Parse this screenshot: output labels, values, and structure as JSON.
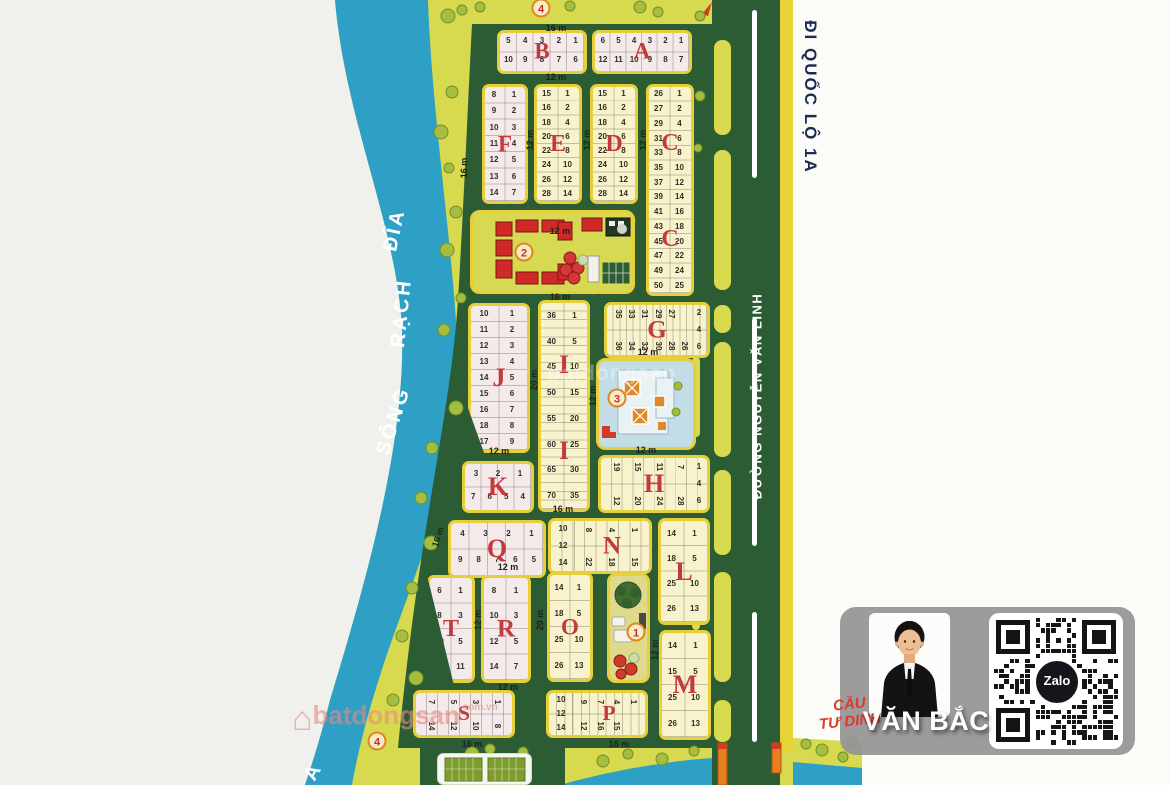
{
  "colors": {
    "paper": "#f0f1ec",
    "paperR": "#fbfbf8",
    "land": "#d7d94f",
    "river": "#2e9fc5",
    "green": "#2b5c33",
    "stripe": "#e8d337",
    "blockBorder": "#e6cf3a",
    "pink": "#f4eaea",
    "lightYellow": "#f8f3cd",
    "letterRed": "#c23a3c",
    "badgeRing": "#e0861f",
    "badgeText": "#cf2b20",
    "navy": "#1c2b52",
    "bridgeRed": "#df392c"
  },
  "map": {
    "river_words": [
      {
        "t": "ĐĨA",
        "x": 395,
        "y": 230,
        "r": -78
      },
      {
        "t": "RẠCH",
        "x": 402,
        "y": 313,
        "r": -84
      },
      {
        "t": "SÔNG",
        "x": 394,
        "y": 421,
        "r": -72
      }
    ],
    "corner_letter": {
      "t": "A"
    },
    "road_main_label": "ĐƯỜNG NGUYỄN VĂN LINH",
    "exit_label": "ĐI QUỐC LỘ 1A",
    "bridge_label_line1": "CẦU",
    "bridge_label_line2": "TƯ DINH",
    "watermark": {
      "text": "batdongsan",
      "suffix": ".com.vn"
    },
    "street_labels": [
      {
        "t": "16 m",
        "x": 556,
        "y": 28,
        "r": 0
      },
      {
        "t": "12 m",
        "x": 556,
        "y": 77,
        "r": 0
      },
      {
        "t": "16 m",
        "x": 464,
        "y": 168,
        "r": -90
      },
      {
        "t": "12 m",
        "x": 530,
        "y": 140,
        "r": -90
      },
      {
        "t": "12 m",
        "x": 587,
        "y": 140,
        "r": -90
      },
      {
        "t": "12 m",
        "x": 643,
        "y": 140,
        "r": -90
      },
      {
        "t": "12 m",
        "x": 560,
        "y": 231,
        "r": 0
      },
      {
        "t": "16 m",
        "x": 560,
        "y": 297,
        "r": 0
      },
      {
        "t": "20 m",
        "x": 534,
        "y": 380,
        "r": -90
      },
      {
        "t": "12 m",
        "x": 593,
        "y": 396,
        "r": -90
      },
      {
        "t": "12 m",
        "x": 648,
        "y": 352,
        "r": 0
      },
      {
        "t": "12 m",
        "x": 499,
        "y": 451,
        "r": 0
      },
      {
        "t": "12 m",
        "x": 646,
        "y": 450,
        "r": 0
      },
      {
        "t": "16 m",
        "x": 563,
        "y": 509,
        "r": 0
      },
      {
        "t": "16 m",
        "x": 438,
        "y": 537,
        "r": -72
      },
      {
        "t": "12 m",
        "x": 508,
        "y": 567,
        "r": 0
      },
      {
        "t": "12 m",
        "x": 478,
        "y": 620,
        "r": -90
      },
      {
        "t": "20 m",
        "x": 540,
        "y": 620,
        "r": -90
      },
      {
        "t": "12 m",
        "x": 655,
        "y": 650,
        "r": -90
      },
      {
        "t": "12 m",
        "x": 508,
        "y": 687,
        "r": 0
      },
      {
        "t": "16 m",
        "x": 472,
        "y": 744,
        "r": 0
      },
      {
        "t": "16 m",
        "x": 619,
        "y": 744,
        "r": 0
      }
    ],
    "badges": [
      {
        "n": "4",
        "x": 541,
        "y": 8
      },
      {
        "n": "2",
        "x": 524,
        "y": 252
      },
      {
        "n": "3",
        "x": 617,
        "y": 398
      },
      {
        "n": "1",
        "x": 636,
        "y": 632
      },
      {
        "n": "4",
        "x": 377,
        "y": 741
      }
    ],
    "blocks": [
      {
        "id": "B",
        "letter": "B",
        "x": 497,
        "y": 30,
        "w": 90,
        "h": 44,
        "fill": "pink",
        "type": "h2",
        "top": [
          "5",
          "4",
          "3",
          "2",
          "1"
        ],
        "bottom": [
          "10",
          "9",
          "8",
          "7",
          "6"
        ]
      },
      {
        "id": "A",
        "letter": "A",
        "x": 592,
        "y": 30,
        "w": 100,
        "h": 44,
        "fill": "pink",
        "type": "h2",
        "top": [
          "6",
          "5",
          "4",
          "3",
          "2",
          "1"
        ],
        "bottom": [
          "12",
          "11",
          "10",
          "9",
          "8",
          "7"
        ]
      },
      {
        "id": "F",
        "letter": "F",
        "x": 482,
        "y": 84,
        "w": 46,
        "h": 120,
        "fill": "pink",
        "type": "v2",
        "left": [
          "8",
          "9",
          "10",
          "11",
          "12",
          "13",
          "14"
        ],
        "right": [
          "1",
          "2",
          "3",
          "4",
          "5",
          "6",
          "7"
        ]
      },
      {
        "id": "E",
        "letter": "E",
        "x": 534,
        "y": 84,
        "w": 48,
        "h": 120,
        "fill": "yellow",
        "type": "v2",
        "left": [
          "15",
          "16",
          "18",
          "20",
          "22",
          "24",
          "26",
          "28"
        ],
        "right": [
          "1",
          "2",
          "4",
          "6",
          "8",
          "10",
          "12",
          "14"
        ]
      },
      {
        "id": "D",
        "letter": "D",
        "x": 590,
        "y": 84,
        "w": 48,
        "h": 120,
        "fill": "yellow",
        "type": "v2",
        "left": [
          "15",
          "16",
          "18",
          "20",
          "22",
          "24",
          "26",
          "28"
        ],
        "right": [
          "1",
          "2",
          "4",
          "6",
          "8",
          "10",
          "12",
          "14"
        ]
      },
      {
        "id": "C",
        "letter": "C",
        "letterPos": [
          0.27,
          0.74
        ],
        "x": 646,
        "y": 84,
        "w": 48,
        "h": 212,
        "fill": "yellow",
        "type": "v2",
        "left": [
          "26",
          "27",
          "29",
          "31",
          "33",
          "35",
          "37",
          "39",
          "41",
          "43",
          "45",
          "47",
          "49",
          "50"
        ],
        "right": [
          "1",
          "2",
          "4",
          "6",
          "8",
          "10",
          "12",
          "14",
          "16",
          "18",
          "20",
          "22",
          "24",
          "25"
        ]
      },
      {
        "id": "J",
        "letter": "J",
        "x": 468,
        "y": 303,
        "w": 62,
        "h": 150,
        "fill": "pink",
        "type": "v2",
        "left": [
          "10",
          "11",
          "12",
          "13",
          "14",
          "15",
          "16",
          "18",
          "17"
        ],
        "right": [
          "1",
          "2",
          "3",
          "4",
          "5",
          "6",
          "7",
          "8",
          "9"
        ],
        "clip": "polygon(0 0, 100% 0, 100% 100%, 26% 100%, 0 70%)"
      },
      {
        "id": "I",
        "letter": "I",
        "letterPos": [
          0.3,
          0.72
        ],
        "x": 538,
        "y": 300,
        "w": 52,
        "h": 212,
        "fill": "yellow",
        "type": "v2",
        "sub": 3,
        "left": [
          "36",
          "40",
          "45",
          "50",
          "55",
          "60",
          "65",
          "70"
        ],
        "right": [
          "1",
          "5",
          "10",
          "15",
          "20",
          "25",
          "30",
          "35"
        ]
      },
      {
        "id": "G",
        "letter": "G",
        "x": 604,
        "y": 302,
        "w": 106,
        "h": 56,
        "fill": "yellow",
        "type": "rot",
        "top": [
          "35",
          "33",
          "31",
          "29",
          "27"
        ],
        "bottom": [
          "36",
          "34",
          "32",
          "30",
          "28",
          "26"
        ],
        "right": [
          "2",
          "4",
          "6"
        ]
      },
      {
        "id": "H",
        "letter": "H",
        "x": 598,
        "y": 455,
        "w": 112,
        "h": 58,
        "fill": "yellow",
        "type": "rot",
        "top": [
          "19",
          "15",
          "11",
          "7"
        ],
        "bottom": [
          "12",
          "20",
          "24",
          "28"
        ],
        "right": [
          "1",
          "4",
          "6"
        ]
      },
      {
        "id": "K",
        "letter": "K",
        "x": 462,
        "y": 461,
        "w": 72,
        "h": 52,
        "fill": "pink",
        "type": "h2",
        "top": [
          "3",
          "2",
          "1"
        ],
        "bottom": [
          "7",
          "6",
          "5",
          "4"
        ]
      },
      {
        "id": "Q",
        "letter": "Q",
        "x": 448,
        "y": 520,
        "w": 98,
        "h": 58,
        "fill": "pink",
        "type": "h2",
        "top": [
          "4",
          "3",
          "2",
          "1"
        ],
        "bottom": [
          "9",
          "8",
          "7",
          "6",
          "5"
        ]
      },
      {
        "id": "N",
        "letter": "N",
        "x": 548,
        "y": 518,
        "w": 104,
        "h": 56,
        "fill": "yellow",
        "type": "rot",
        "leftCol": [
          "10",
          "12",
          "14"
        ],
        "top": [
          "8",
          "4",
          "1"
        ],
        "bottom": [
          "22",
          "18",
          "15"
        ]
      },
      {
        "id": "L",
        "letter": "L",
        "x": 658,
        "y": 518,
        "w": 52,
        "h": 107,
        "fill": "yellow",
        "type": "v2",
        "left": [
          "14",
          "18",
          "25",
          "26"
        ],
        "right": [
          "1",
          "5",
          "10",
          "13"
        ]
      },
      {
        "id": "T",
        "letter": "T",
        "x": 427,
        "y": 575,
        "w": 48,
        "h": 108,
        "fill": "pink",
        "type": "v2",
        "left": [
          "6",
          "8",
          "10",
          "13"
        ],
        "right": [
          "1",
          "3",
          "5",
          "11"
        ],
        "clip": "polygon(0 0, 100% 0, 100% 100%, 55% 100%)"
      },
      {
        "id": "R",
        "letter": "R",
        "x": 481,
        "y": 575,
        "w": 50,
        "h": 108,
        "fill": "pink",
        "type": "v2",
        "left": [
          "8",
          "10",
          "12",
          "14"
        ],
        "right": [
          "1",
          "3",
          "5",
          "7"
        ]
      },
      {
        "id": "O",
        "letter": "O",
        "x": 547,
        "y": 572,
        "w": 46,
        "h": 110,
        "fill": "yellow",
        "type": "v2",
        "left": [
          "14",
          "18",
          "25",
          "26"
        ],
        "right": [
          "1",
          "5",
          "10",
          "13"
        ]
      },
      {
        "id": "M",
        "letter": "M",
        "x": 659,
        "y": 630,
        "w": 52,
        "h": 110,
        "fill": "yellow",
        "type": "v2",
        "left": [
          "14",
          "15",
          "25",
          "26"
        ],
        "right": [
          "1",
          "5",
          "10",
          "13"
        ]
      },
      {
        "id": "S",
        "letter": "S",
        "x": 413,
        "y": 690,
        "w": 102,
        "h": 48,
        "fill": "pink",
        "type": "rot",
        "top": [
          "7",
          "5",
          "3",
          "1"
        ],
        "bottom": [
          "14",
          "12",
          "10",
          "8"
        ]
      },
      {
        "id": "P",
        "letter": "P",
        "x": 546,
        "y": 690,
        "w": 102,
        "h": 48,
        "fill": "yellow",
        "type": "rot",
        "leftCol": [
          "10",
          "12",
          "14"
        ],
        "top": [
          "9",
          "7",
          "4",
          "1"
        ],
        "bottom": [
          "12",
          "16",
          "15"
        ]
      }
    ]
  },
  "card": {
    "agent_name": "VĂN BẮC",
    "qr_badge": "Zalo"
  }
}
